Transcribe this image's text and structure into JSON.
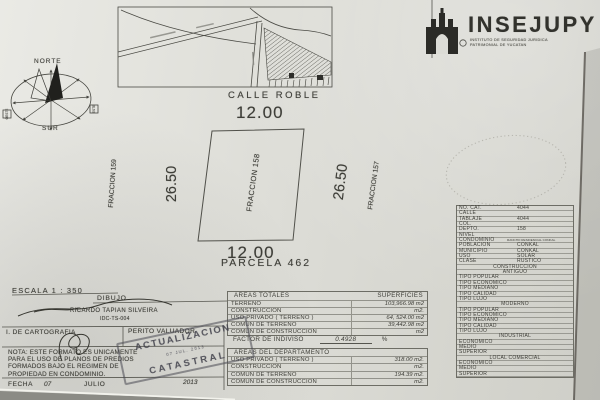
{
  "logo": {
    "name": "INSEJUPY",
    "sub1": "INSTITUTO DE SEGURIDAD JURIDICA",
    "sub2": "PATRIMONIAL DE YUCATAN"
  },
  "map": {
    "street_label": "CALLE ROBLE"
  },
  "compass": {
    "north": "NORTE",
    "south": "SUR",
    "east": "ESTE",
    "west": "OESTE"
  },
  "plot": {
    "top_dim": "12.00",
    "bottom_dim": "12.00",
    "left_dim": "26.50",
    "right_dim": "26.50",
    "center_label": "FRACCION 158",
    "left_label": "FRACCION 159",
    "right_label": "FRACCION 157",
    "parcel_label": "PARCELA 462"
  },
  "scale_label": "ESCALA  1 : 350",
  "drawing": {
    "header": "DIBUJO",
    "author": "RICARDO TAPIAN SILVEIRA",
    "code": "IDC-TS-004"
  },
  "signoff": {
    "left": "I. DE CARTOGRAFIA",
    "right": "PERITO VALUADOR"
  },
  "note": {
    "lines": [
      "NOTA: ESTE FORMATO ES UNICAMENTE",
      "PARA EL USO DE PLANOS DE PREDIOS",
      "FORMADOS BAJO EL REGIMEN DE",
      "PROPIEDAD EN CONDOMINIO."
    ]
  },
  "fecha": {
    "label": "FECHA",
    "day": "07",
    "month": "JULIO",
    "year": "2013"
  },
  "stamp": {
    "line1": "ACTUALIZACION",
    "date_line": "07 JUL. 2013",
    "line2": "CATASTRAL"
  },
  "areas_totales": {
    "title": "AREAS TOTALES",
    "col2": "SUPERFICIES",
    "rows": [
      [
        "TERRENO",
        "103,966.98 m2"
      ],
      [
        "CONSTRUCCION",
        "m2."
      ],
      [
        "USO PRIVADO ( TERRENO )",
        "64, 524.00 m2"
      ],
      [
        "COMUN DE TERRENO",
        "39,442.98 m2"
      ],
      [
        "COMUN DE CONSTRUCCION",
        "m2"
      ]
    ],
    "factor_label": "FACTOR DE INDIVISO",
    "factor_value": "0.4928",
    "factor_unit": "%"
  },
  "areas_departamento": {
    "title": "AREAS DEL DEPARTAMENTO",
    "rows": [
      [
        "USO PRIVADO ( TERRENO )",
        "318.00 m2."
      ],
      [
        "CONSTRUCCION",
        "m2."
      ],
      [
        "COMUN DE TERRENO",
        "194.39 m2."
      ],
      [
        "COMUN DE CONSTRUCCION",
        "m2."
      ]
    ]
  },
  "cadastral": {
    "rows": [
      {
        "label": "NO. CAT.",
        "value": "4044"
      },
      {
        "label": "CALLE",
        "value": ""
      },
      {
        "label": "TABLAJE",
        "value": "4044"
      },
      {
        "label": "COL.",
        "value": ""
      },
      {
        "label": "DEPTO.",
        "value": "158"
      },
      {
        "label": "NIVEL",
        "value": ""
      },
      {
        "label": "CONDOMINIO",
        "value": "RANCHO RESIDENCIAL CONKAL",
        "small": true
      },
      {
        "label": "POBLACION",
        "value": "CONKAL"
      },
      {
        "label": "MUNICIPIO",
        "value": "CONKAL"
      },
      {
        "label": "USO",
        "value": "SOLAR"
      },
      {
        "label": "CLASE",
        "value": "RUSTICO"
      },
      {
        "label": "CONSTRUCCION",
        "value": "",
        "header": true
      },
      {
        "label": "ANTIGUO",
        "value": "",
        "header": true
      },
      {
        "label": "TIPO POPULAR",
        "value": ""
      },
      {
        "label": "TIPO ECONOMICO",
        "value": ""
      },
      {
        "label": "TIPO MEDIANO",
        "value": ""
      },
      {
        "label": "TIPO CALIDAD",
        "value": ""
      },
      {
        "label": "TIPO LUJO",
        "value": ""
      },
      {
        "label": "MODERNO",
        "value": "",
        "header": true
      },
      {
        "label": "TIPO POPULAR",
        "value": ""
      },
      {
        "label": "TIPO ECONOMICO",
        "value": ""
      },
      {
        "label": "TIPO MEDIANO",
        "value": ""
      },
      {
        "label": "TIPO CALIDAD",
        "value": ""
      },
      {
        "label": "TIPO LUJO",
        "value": ""
      },
      {
        "label": "INDUSTRIAL",
        "value": "",
        "header": true
      },
      {
        "label": "ECONOMICO",
        "value": ""
      },
      {
        "label": "MEDIO",
        "value": ""
      },
      {
        "label": "SUPERIOR",
        "value": ""
      },
      {
        "label": "LOCAL COMERCIAL",
        "value": "",
        "header": true
      },
      {
        "label": "ECONOMICO",
        "value": ""
      },
      {
        "label": "MEDIO",
        "value": ""
      },
      {
        "label": "SUPERIOR",
        "value": ""
      }
    ]
  },
  "colors": {
    "ink": "#3e3e38",
    "paper": "#dcdcd6",
    "stamp_ink": "#42424a"
  }
}
